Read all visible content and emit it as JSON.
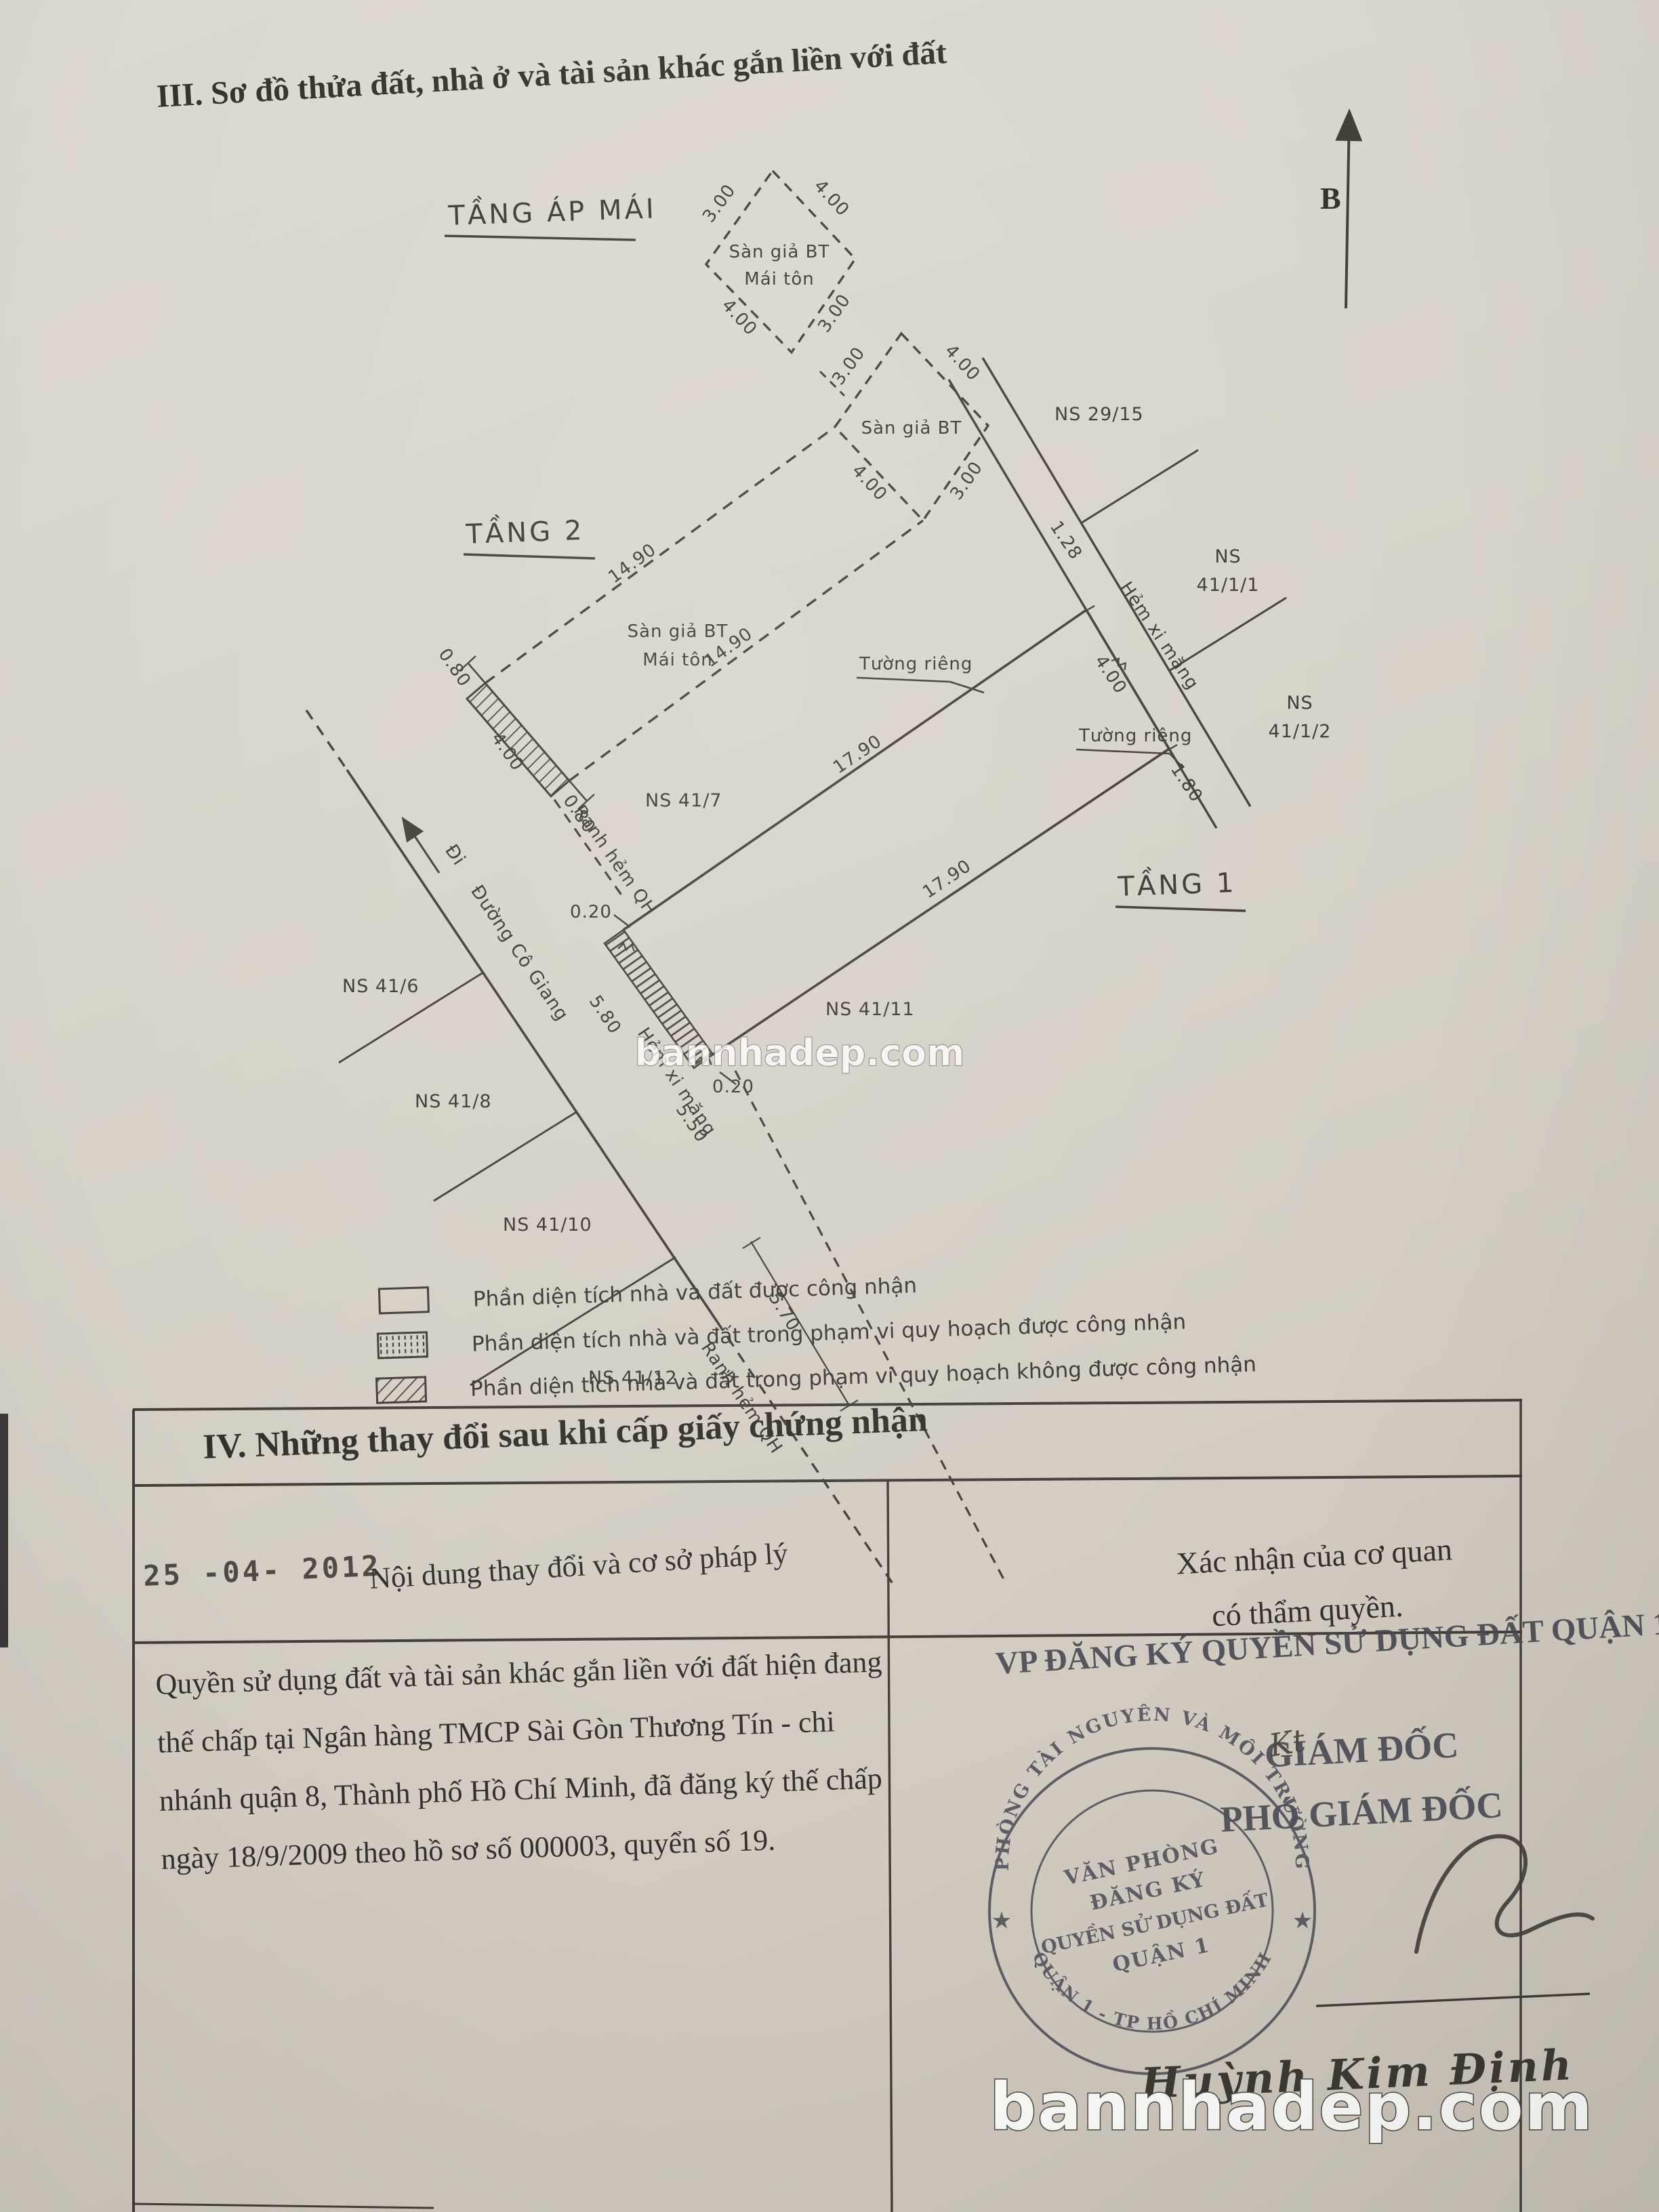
{
  "title": "III. Sơ đồ thửa đất, nhà ở và tài sản khác gắn liền với đất",
  "north": "B",
  "colors": {
    "ink": "#3e3a34",
    "paper": "#d9d4cb",
    "seal": "#4d4d57",
    "watermark": "#ffffff"
  },
  "diagram": {
    "attic": {
      "title": "TẦNG ÁP MÁI",
      "room1": "Sàn giả BT",
      "room2": "Mái tôn",
      "d_tl": "3.00",
      "d_tr": "4.00",
      "d_bl": "4.00",
      "d_br": "3.00"
    },
    "roof2": {
      "room": "Sàn giả BT",
      "d_tl": "3.00",
      "d_tr": "4.00",
      "d_bl": "4.00",
      "d_br": "3.00"
    },
    "floor2": {
      "title": "TẦNG 2",
      "room1": "Sàn giả BT",
      "room2": "Mái tôn",
      "len1": "14.90",
      "len2": "14.90",
      "f_top": "0.80",
      "f_mid": "4.00",
      "f_bot": "0.80"
    },
    "floor1": {
      "title": "TẦNG 1",
      "len1": "17.90",
      "len2": "17.90",
      "back": "4.00",
      "s1": "0.20",
      "s2": "0.20",
      "wall1": "Tường riêng",
      "wall2": "Tường riêng"
    },
    "alley_ne": {
      "name": "Hẻm xi măng",
      "d1": "1.28",
      "d2": "4.00",
      "d3": "1.80"
    },
    "alley_sw": {
      "name": "Hẻm xi măng",
      "d1": "5.80",
      "d2": "5.50",
      "d3": "5.70"
    },
    "qh1": "Ranh hẻm QH",
    "qh2": "Ranh hẻm QH",
    "road": {
      "go": "Đi",
      "name": "Đường Cô Giang"
    },
    "parcels": {
      "p29_15": "NS 29/15",
      "p41_1_1a": "NS",
      "p41_1_1b": "41/1/1",
      "p41_1_2a": "NS",
      "p41_1_2b": "41/1/2",
      "p41_6": "NS 41/6",
      "p41_7": "NS 41/7",
      "p41_8": "NS 41/8",
      "p41_10": "NS 41/10",
      "p41_11": "NS 41/11",
      "p41_12": "NS 41/12"
    }
  },
  "legend": {
    "items": [
      {
        "label": "Phần diện tích nhà và đất được công nhận"
      },
      {
        "label": "Phần diện tích nhà và đất trong phạm vi quy hoạch được công nhận"
      },
      {
        "label": "Phần diện tích nhà và đất trong phạm vi quy hoạch không được công nhận"
      }
    ]
  },
  "section4": {
    "heading": "IV. Những thay đổi sau khi cấp giấy chứng nhận",
    "date_stamp": "25 -04- 2012",
    "col_left": "Nội dung thay đổi và cơ sở pháp lý",
    "col_right_1": "Xác nhận của cơ quan",
    "col_right_2": "có thẩm quyền.",
    "body": [
      "Quyền sử dụng đất và tài sản khác gắn liền với đất hiện đang",
      "thế chấp tại Ngân hàng TMCP Sài Gòn Thương Tín - chi",
      "nhánh quận 8, Thành phố Hồ Chí Minh, đã đăng ký thế chấp",
      "ngày 18/9/2009 theo hồ sơ số 000003, quyển số 19."
    ]
  },
  "approval": {
    "office": "VP ĐĂNG KÝ QUYỀN SỬ DỤNG ĐẤT QUẬN 1",
    "kt": "Kt",
    "title1": "GIÁM ĐỐC",
    "title2": "PHÓ GIÁM ĐỐC",
    "signer": "Huỳnh Kim Định"
  },
  "seal": {
    "arc_top": "PHÒNG TÀI NGUYÊN VÀ MÔI TRƯỜNG",
    "arc_bottom": "QUẬN 1 - TP HỒ CHÍ MINH",
    "line1": "VĂN PHÒNG",
    "line2": "ĐĂNG KÝ",
    "line3": "QUYỀN SỬ DỤNG ĐẤT",
    "line4": "QUẬN 1",
    "star": "★"
  },
  "watermark": {
    "mid": "bannhadep.com",
    "bottom": "bannhadep.com"
  }
}
